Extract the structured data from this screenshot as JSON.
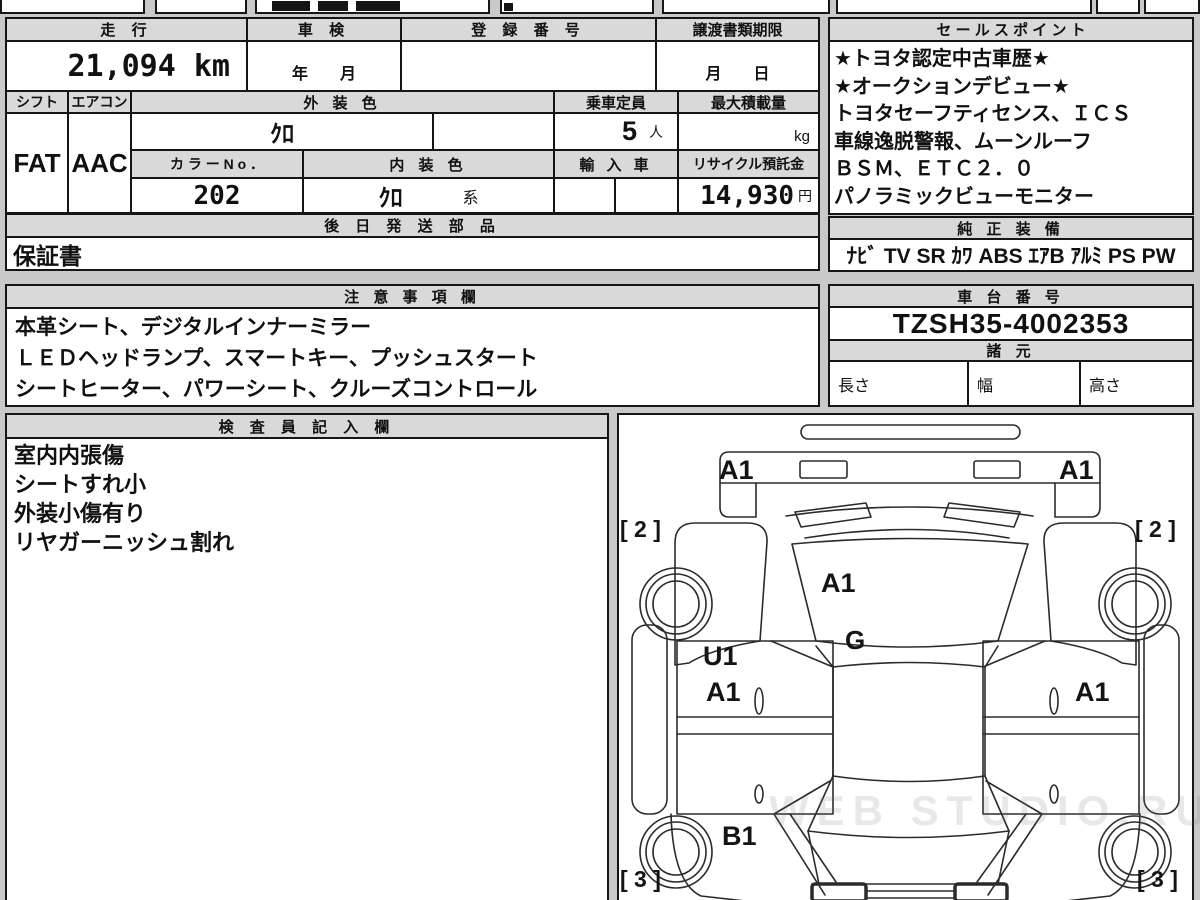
{
  "top_table": {
    "mileage_label": "走 行",
    "mileage_value": "21,094 km",
    "inspection_label": "車 検",
    "inspection_value": "年　　月",
    "registration_label": "登 録 番 号",
    "registration_value": "",
    "deadline_label": "譲渡書類期限",
    "deadline_value": "月　　日",
    "shift_label": "シフト",
    "shift_value": "FAT",
    "aircon_label": "エアコン",
    "aircon_value": "AAC",
    "exterior_color_label": "外 装 色",
    "exterior_color_value": "ｸﾛ",
    "capacity_label": "乗車定員",
    "capacity_value": "5",
    "capacity_unit": "人",
    "max_load_label": "最大積載量",
    "max_load_value": "",
    "max_load_unit": "kg",
    "color_no_label": "カ ラ ー N o ．",
    "color_no_value": "202",
    "interior_color_label": "内 装 色",
    "interior_color_value": "ｸﾛ",
    "interior_color_suffix": "系",
    "import_label": "輸 入 車",
    "import_value": "",
    "recycle_label": "リサイクル預託金",
    "recycle_value": "14,930",
    "recycle_unit": "円",
    "later_parts_label": "後 日 発 送 部 品",
    "later_parts_value": "保証書"
  },
  "sales_points": {
    "title": "セ ー ル ス ポ イ ン ト",
    "lines": [
      "★トヨタ認定中古車歴★",
      "★オークションデビュー★",
      "トヨタセーフティセンス、ＩＣＳ",
      "車線逸脱警報、ムーンルーフ",
      "ＢＳＭ、ＥＴＣ２．０",
      "パノラミックビューモニター"
    ]
  },
  "equipment": {
    "title": "純 正 装 備",
    "value": "ﾅﾋﾞ TV SR ｶﾜ ABS ｴｱB ｱﾙﾐ PS PW"
  },
  "notes": {
    "title": "注 意 事 項 欄",
    "lines": [
      "本革シート、デジタルインナーミラー",
      "ＬＥＤヘッドランプ、スマートキー、プッシュスタート",
      "シートヒーター、パワーシート、クルーズコントロール"
    ]
  },
  "chassis": {
    "title": "車 台 番 号",
    "value": "TZSH35-4002353"
  },
  "specs": {
    "title": "諸 元",
    "length_label": "長さ",
    "width_label": "幅",
    "height_label": "高さ"
  },
  "inspector": {
    "title": "検 査 員 記 入 欄",
    "lines": [
      "室内内張傷",
      "シートすれ小",
      "外装小傷有り",
      "リヤガーニッシュ割れ"
    ]
  },
  "diagram": {
    "marks": {
      "bumper_left": "A1",
      "bumper_right": "A1",
      "hood": "A1",
      "cowl": "G",
      "side_front_left": "[ 2 ]",
      "side_front_right": "[ 2 ]",
      "door_left_upper": "U1",
      "door_left": "A1",
      "door_right": "A1",
      "rear_left": "B1",
      "side_rear_left": "[ 3 ]",
      "side_rear_right": "[ 3 ]"
    },
    "watermark": "WEB STUDIO.RU"
  }
}
